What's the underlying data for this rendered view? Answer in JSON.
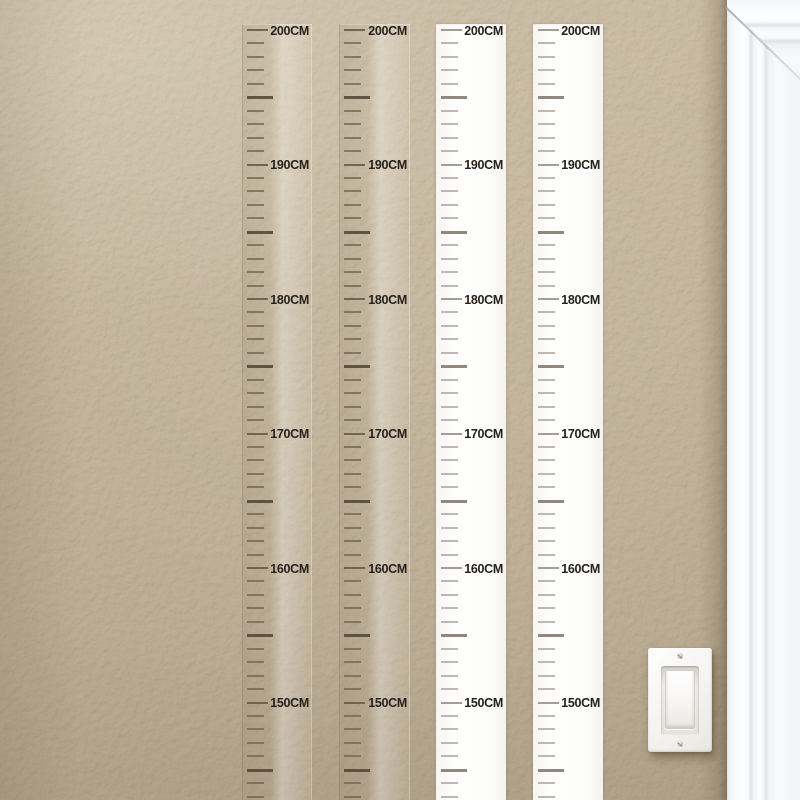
{
  "scene": {
    "subject": "height measurement ruler wall decals on textured beige wall beside white door casing and rocker light switch"
  },
  "colors": {
    "wall": "#c6b79e",
    "wall-shadow": "#9a8b71",
    "casing-white": "#f6f8fa",
    "ruler-white": "#fdfdfc",
    "switch-white": "#f4f3f0",
    "label-text": "#26211a",
    "tick-transparent-minor": "#77694f",
    "tick-transparent-mid": "#584b3a",
    "tick-transparent-major": "#695c47",
    "tick-white-minor": "#bcb8b1",
    "tick-white-mid": "#8e887f",
    "tick-white-major": "#a39d95"
  },
  "ruler_chart": {
    "unit": "CM",
    "top_cm": 200,
    "bottom_cm": 143,
    "minor_step_cm": 1,
    "mid_step_cm": 5,
    "label_step_cm": 10,
    "labels": [
      {
        "cm": 200,
        "text": "200CM"
      },
      {
        "cm": 190,
        "text": "190CM"
      },
      {
        "cm": 180,
        "text": "180CM"
      },
      {
        "cm": 170,
        "text": "170CM"
      },
      {
        "cm": 160,
        "text": "160CM"
      },
      {
        "cm": 150,
        "text": "150CM"
      }
    ],
    "geometry": {
      "panel_top_px": 24,
      "first_tick_y_px": 29,
      "px_per_cm": 13.45,
      "panel_height_px": 776
    },
    "rulers": [
      {
        "name": "growth-ruler-transparent-1",
        "variant": "transparent",
        "left_px": 242,
        "width_px": 70
      },
      {
        "name": "growth-ruler-transparent-2",
        "variant": "transparent",
        "left_px": 339,
        "width_px": 71
      },
      {
        "name": "growth-ruler-white-1",
        "variant": "white",
        "left_px": 436,
        "width_px": 70
      },
      {
        "name": "growth-ruler-white-2",
        "variant": "white",
        "left_px": 533,
        "width_px": 70
      }
    ]
  },
  "fixtures": {
    "light_switch": {
      "style": "rocker",
      "screws": 2
    },
    "door_casing": {
      "position": "right-edge",
      "miter_corner": "top"
    }
  }
}
